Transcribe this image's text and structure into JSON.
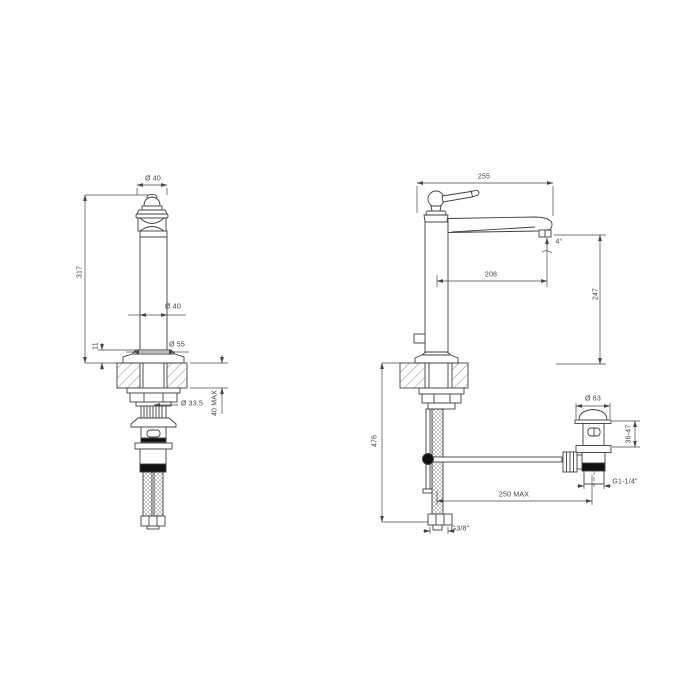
{
  "page": {
    "background": "#ffffff"
  },
  "drawing": {
    "kind": "technical-dimension-drawing",
    "subject": "tall single-hole basin mixer with pop-up waste",
    "line_color": "#3f3f3f",
    "accent_black": "#111111",
    "front_view": {
      "labels": {
        "top_diameter": "Ø 40",
        "height": "317",
        "body_diameter": "Ø 40",
        "base_diameter": "Ø 55",
        "base_height": "11",
        "max_counter_thickness": "40 MAX",
        "shank_diameter": "Ø 33.5"
      }
    },
    "side_view": {
      "labels": {
        "overall_projection": "255",
        "spout_angle": "4°",
        "spout_projection": "208",
        "spout_height": "247",
        "under_counter_depth": "476",
        "rod_projection": "250 MAX",
        "supply_hose_thread": "G3/8\""
      }
    },
    "drain_detail": {
      "labels": {
        "cap_diameter": "Ø 63",
        "mounting_range": "36-47",
        "waste_thread": "G1-1/4\""
      }
    }
  }
}
